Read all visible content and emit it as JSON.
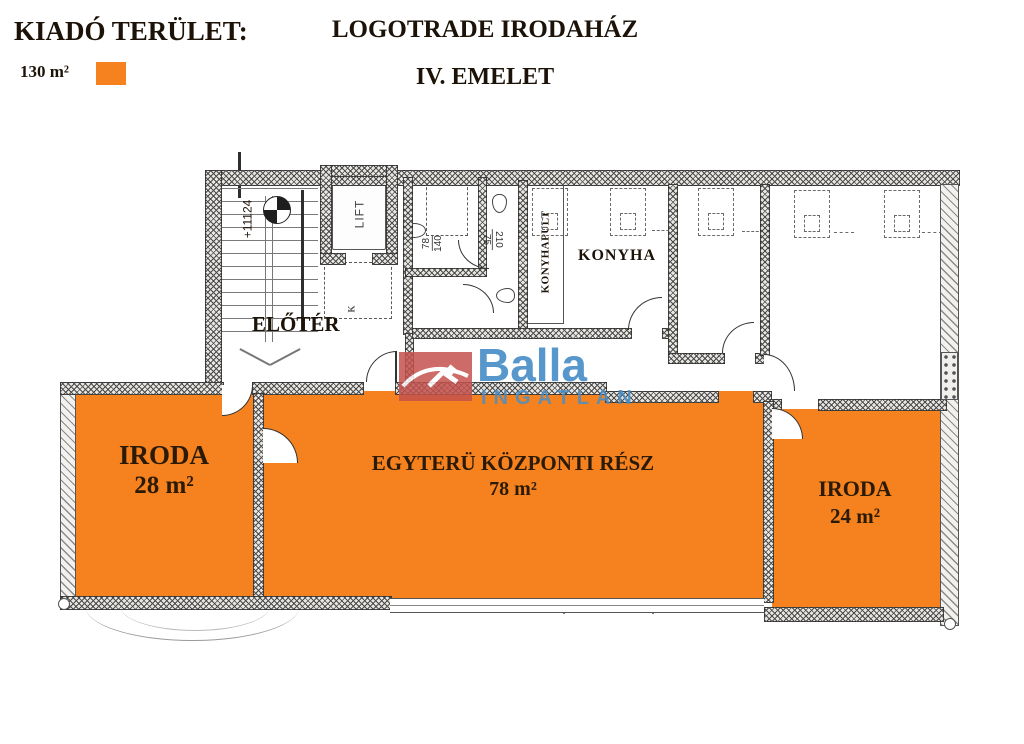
{
  "legend": {
    "title": "KIADÓ TERÜLET:",
    "area": "130 m²"
  },
  "header": {
    "building": "LOGOTRADE IRODAHÁZ",
    "floor": "IV. EMELET"
  },
  "plan": {
    "labels": {
      "entry": "ELŐTÉR",
      "kitchen": "KONYHA",
      "kitchen_counter": "KONYHAPULT",
      "lift": "LIFT",
      "level_mark": "+11124",
      "stair_mark": "K"
    },
    "dims": {
      "wc_width": "78",
      "wc_depth": "140",
      "wc2_width": "75",
      "wc2_depth": "210"
    }
  },
  "rooms": [
    {
      "name": "IRODA",
      "area": "28 m²"
    },
    {
      "name": "EGYTERÜ KÖZPONTI RÉSZ",
      "area": "78 m²"
    },
    {
      "name": "IRODA",
      "area": "24 m²"
    }
  ],
  "watermark": {
    "brand": "Balla",
    "sub": "INGATLAN"
  },
  "colors": {
    "highlight": "#F5821E",
    "logo_red": "#C4524D",
    "logo_blue": "#4A8FC7",
    "label_text": "#2b1a05"
  }
}
